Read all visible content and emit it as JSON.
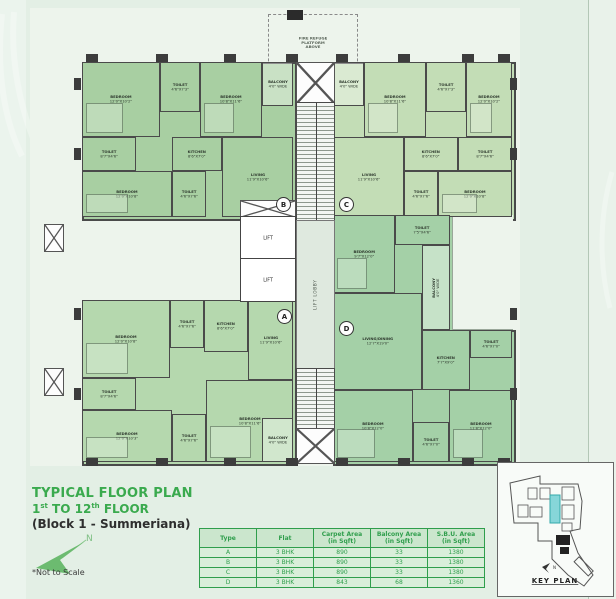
{
  "colors": {
    "bg": "#e3efe5",
    "paper": "#edf4ec",
    "accent_green": "#3aaa4e",
    "table_green": "#2f9e4c",
    "flat_a": "#b5d8ae",
    "flat_b": "#a8cfa2",
    "flat_c": "#c3ddb6",
    "flat_d": "#a4d0a7",
    "wall": "#4a4a4a",
    "key_highlight": "#86d6d9"
  },
  "title": {
    "line1": "TYPICAL FLOOR PLAN",
    "line2_a": "1",
    "line2_sup1": "st",
    "line2_b": " TO 12",
    "line2_sup2": "th",
    "line2_c": " FLOOR",
    "line3": "(Block 1 - Summeriana)",
    "north_label": "N",
    "not_to_scale": "*Not to Scale"
  },
  "plan": {
    "fire_refuge_note": "FIRE REFUGE\nPLATFORM\nABOVE",
    "lift_label": "LIFT",
    "lift_lobby_label": "LIFT LOBBY",
    "markers": [
      {
        "letter": "B",
        "x": 252,
        "y": 195
      },
      {
        "letter": "C",
        "x": 315,
        "y": 195
      },
      {
        "letter": "A",
        "x": 253,
        "y": 307
      },
      {
        "letter": "D",
        "x": 315,
        "y": 319
      }
    ],
    "rooms": [
      {
        "flat": "B",
        "label": "BEDROOM",
        "dims": "12'0\"X10'2\"",
        "x": 52,
        "y": 54,
        "w": 78,
        "h": 75
      },
      {
        "flat": "B",
        "label": "TOILET",
        "dims": "4'6\"X7'3\"",
        "x": 130,
        "y": 54,
        "w": 40,
        "h": 50
      },
      {
        "flat": "B",
        "label": "BEDROOM",
        "dims": "10'8\"X11'6\"",
        "x": 170,
        "y": 54,
        "w": 62,
        "h": 75
      },
      {
        "flat": "B",
        "label": "BALCONY",
        "dims": "4'0\" WIDE",
        "x": 232,
        "y": 54,
        "w": 31,
        "h": 44
      },
      {
        "flat": "B",
        "label": "TOILET",
        "dims": "8'7\"X4'6\"",
        "x": 52,
        "y": 129,
        "w": 54,
        "h": 34
      },
      {
        "flat": "B",
        "label": "BEDROOM",
        "dims": "12'0\"X10'8\"",
        "x": 52,
        "y": 163,
        "w": 90,
        "h": 46
      },
      {
        "flat": "B",
        "label": "TOILET",
        "dims": "4'6\"X7'6\"",
        "x": 142,
        "y": 163,
        "w": 34,
        "h": 46
      },
      {
        "flat": "B",
        "label": "KITCHEN",
        "dims": "8'6\"X7'0\"",
        "x": 142,
        "y": 129,
        "w": 50,
        "h": 34
      },
      {
        "flat": "B",
        "label": "LIVING",
        "dims": "11'9\"X10'6\"",
        "x": 192,
        "y": 129,
        "w": 71,
        "h": 80
      },
      {
        "flat": "C",
        "label": "BALCONY",
        "dims": "4'0\" WIDE",
        "x": 303,
        "y": 54,
        "w": 31,
        "h": 44
      },
      {
        "flat": "C",
        "label": "BEDROOM",
        "dims": "10'8\"X11'6\"",
        "x": 334,
        "y": 54,
        "w": 62,
        "h": 75
      },
      {
        "flat": "C",
        "label": "TOILET",
        "dims": "4'6\"X7'3\"",
        "x": 396,
        "y": 54,
        "w": 40,
        "h": 50
      },
      {
        "flat": "C",
        "label": "BEDROOM",
        "dims": "12'0\"X10'2\"",
        "x": 436,
        "y": 54,
        "w": 46,
        "h": 75
      },
      {
        "flat": "C",
        "label": "LIVING",
        "dims": "11'9\"X10'6\"",
        "x": 303,
        "y": 129,
        "w": 71,
        "h": 80
      },
      {
        "flat": "C",
        "label": "KITCHEN",
        "dims": "8'6\"X7'0\"",
        "x": 374,
        "y": 129,
        "w": 54,
        "h": 34
      },
      {
        "flat": "C",
        "label": "TOILET",
        "dims": "4'6\"X7'6\"",
        "x": 374,
        "y": 163,
        "w": 34,
        "h": 46
      },
      {
        "flat": "C",
        "label": "TOILET",
        "dims": "8'7\"X4'6\"",
        "x": 428,
        "y": 129,
        "w": 54,
        "h": 34
      },
      {
        "flat": "C",
        "label": "BEDROOM",
        "dims": "12'0\"X10'8\"",
        "x": 408,
        "y": 163,
        "w": 74,
        "h": 46
      },
      {
        "flat": "A",
        "label": "BEDROOM",
        "dims": "12'0\"X10'8\"",
        "x": 52,
        "y": 292,
        "w": 88,
        "h": 78
      },
      {
        "flat": "A",
        "label": "TOILET",
        "dims": "4'6\"X7'6\"",
        "x": 140,
        "y": 292,
        "w": 34,
        "h": 48
      },
      {
        "flat": "A",
        "label": "KITCHEN",
        "dims": "8'6\"X7'0\"",
        "x": 174,
        "y": 292,
        "w": 44,
        "h": 52
      },
      {
        "flat": "A",
        "label": "LIVING",
        "dims": "11'9\"X10'6\"",
        "x": 218,
        "y": 292,
        "w": 45,
        "h": 80
      },
      {
        "flat": "A",
        "label": "TOILET",
        "dims": "8'7\"X4'6\"",
        "x": 52,
        "y": 370,
        "w": 54,
        "h": 32
      },
      {
        "flat": "A",
        "label": "BEDROOM",
        "dims": "12'0\"X10'3\"",
        "x": 52,
        "y": 402,
        "w": 90,
        "h": 52
      },
      {
        "flat": "A",
        "label": "TOILET",
        "dims": "4'6\"X7'6\"",
        "x": 142,
        "y": 406,
        "w": 34,
        "h": 48
      },
      {
        "flat": "A",
        "label": "BEDROOM",
        "dims": "10'8\"X11'6\"",
        "x": 176,
        "y": 372,
        "w": 87,
        "h": 82
      },
      {
        "flat": "A",
        "label": "BALCONY",
        "dims": "4'0\" WIDE",
        "x": 232,
        "y": 410,
        "w": 31,
        "h": 44
      },
      {
        "flat": "D",
        "label": "BEDROOM",
        "dims": "9'7\"X12'0\"",
        "x": 303,
        "y": 207,
        "w": 62,
        "h": 78
      },
      {
        "flat": "D",
        "label": "TOILET",
        "dims": "7'5\"X4'6\"",
        "x": 365,
        "y": 207,
        "w": 55,
        "h": 30
      },
      {
        "flat": "D",
        "label": "BALCONY",
        "dims": "4'0\" WIDE",
        "x": 392,
        "y": 237,
        "w": 28,
        "h": 85,
        "vert": true
      },
      {
        "flat": "D",
        "label": "LIVING/DINING",
        "dims": "12'7\"X19'0\"",
        "x": 303,
        "y": 285,
        "w": 89,
        "h": 97
      },
      {
        "flat": "D",
        "label": "KITCHEN",
        "dims": "7'7\"X9'0\"",
        "x": 392,
        "y": 322,
        "w": 48,
        "h": 60
      },
      {
        "flat": "D",
        "label": "TOILET",
        "dims": "4'6\"X7'0\"",
        "x": 440,
        "y": 322,
        "w": 42,
        "h": 28
      },
      {
        "flat": "D",
        "label": "BEDROOM",
        "dims": "10'8\"X12'0\"",
        "x": 303,
        "y": 382,
        "w": 80,
        "h": 72
      },
      {
        "flat": "D",
        "label": "TOILET",
        "dims": "4'6\"X7'0\"",
        "x": 383,
        "y": 414,
        "w": 36,
        "h": 40
      },
      {
        "flat": "D",
        "label": "BEDROOM",
        "dims": "11'8\"X12'0\"",
        "x": 419,
        "y": 382,
        "w": 63,
        "h": 72
      }
    ]
  },
  "legend_table": {
    "headers": [
      "Type",
      "Flat",
      "Carpet Area\n(in Sqft)",
      "Balcony Area\n(in Sqft)",
      "S.B.U. Area\n(in Sqft)"
    ],
    "rows": [
      [
        "A",
        "3 BHK",
        "890",
        "33",
        "1380"
      ],
      [
        "B",
        "3 BHK",
        "890",
        "33",
        "1380"
      ],
      [
        "C",
        "3 BHK",
        "890",
        "33",
        "1380"
      ],
      [
        "D",
        "3 BHK",
        "843",
        "68",
        "1360"
      ]
    ]
  },
  "key_plan": {
    "label": "KEY PLAN",
    "north_label": "N"
  }
}
